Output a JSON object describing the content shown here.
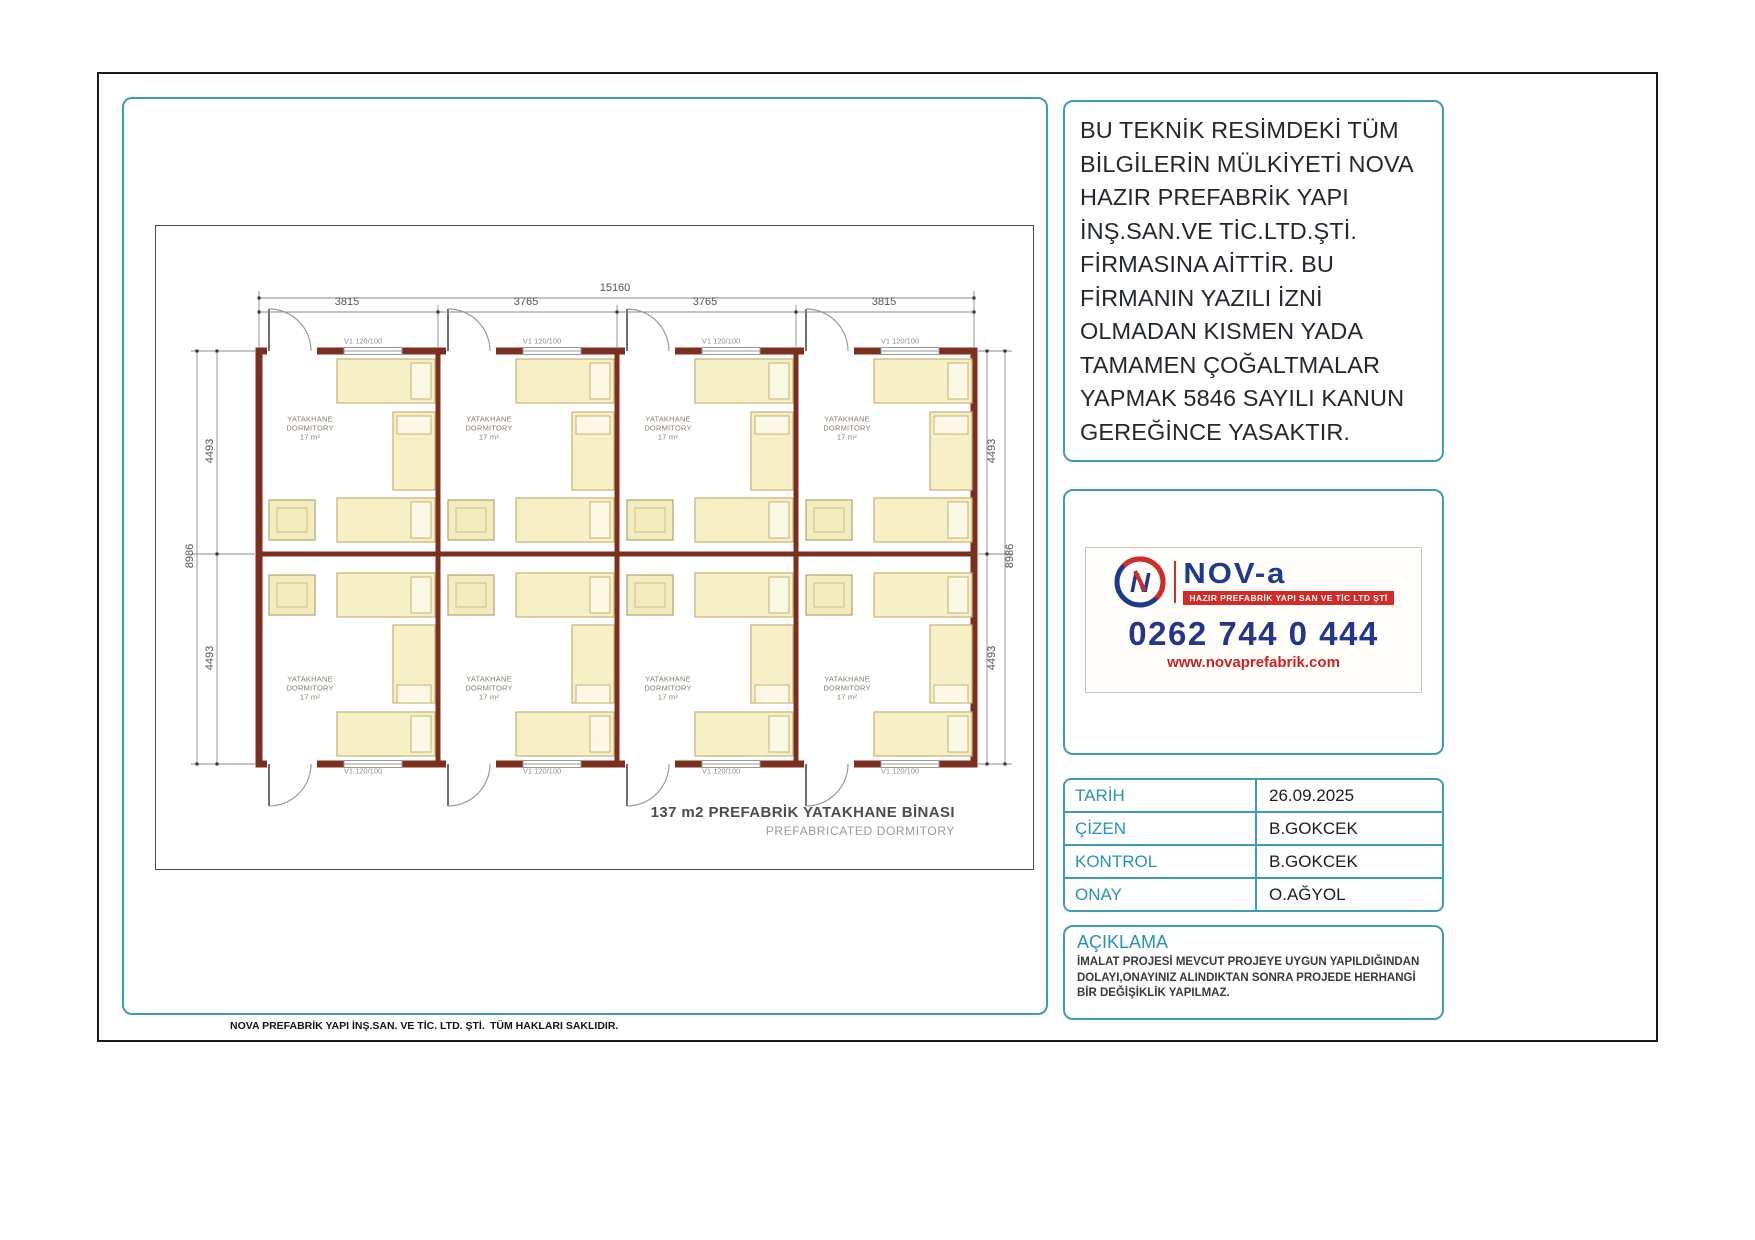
{
  "sheet": {
    "footer_left": "NOVA  PREFABRİK YAPI İNŞ.SAN. VE TİC. LTD. ŞTİ.",
    "footer_center": "TÜM HAKLARI SAKLIDIR."
  },
  "legal_notice": "BU TEKNİK RESİMDEKİ TÜM BİLGİLERİN MÜLKİYETİ NOVA HAZIR PREFABRİK YAPI İNŞ.SAN.VE TİC.LTD.ŞTİ. FİRMASINA AİTTİR. BU FİRMANIN YAZILI İZNİ OLMADAN KISMEN YADA TAMAMEN ÇOĞALTMALAR YAPMAK 5846 SAYILI KANUN GEREĞİNCE YASAKTIR.",
  "drawing": {
    "title": "137 m2 PREFABRİK YATAKHANE BİNASI",
    "subtitle": "PREFABRICATED DORMITORY",
    "room_label": {
      "tr": "YATAKHANE",
      "en": "DORMITORY",
      "area": "17 m²"
    },
    "window_label": "V1 120/100",
    "dimensions": {
      "total_width": "15160",
      "segments_top": [
        "3815",
        "3765",
        "3765",
        "3815"
      ],
      "side_half": "4493",
      "side_total": "8986"
    }
  },
  "brand": {
    "wordmark": "NOV-a",
    "tagline": "HAZIR PREFABRİK YAPI SAN VE TİC LTD ŞTİ",
    "phone": "0262 744 0 444",
    "website": "www.novaprefabrik.com"
  },
  "title_block": {
    "rows": [
      {
        "label": "TARİH",
        "value": "26.09.2025"
      },
      {
        "label": "ÇİZEN",
        "value": "B.GOKCEK"
      },
      {
        "label": "KONTROL",
        "value": "B.GOKCEK"
      },
      {
        "label": "ONAY",
        "value": "O.AĞYOL"
      }
    ]
  },
  "remarks": {
    "heading": "AÇIKLAMA",
    "body": "İMALAT PROJESİ MEVCUT PROJEYE UYGUN YAPILDIĞINDAN DOLAYI,ONAYINIZ ALINDIKTAN SONRA PROJEDE HERHANGİ BİR DEĞİŞİKLİK YAPILMAZ."
  },
  "colors": {
    "accent_teal": "#3d9cb8",
    "wall_maroon": "#7d2f1f",
    "brand_navy": "#1d3a8f",
    "brand_red": "#d42b27"
  }
}
